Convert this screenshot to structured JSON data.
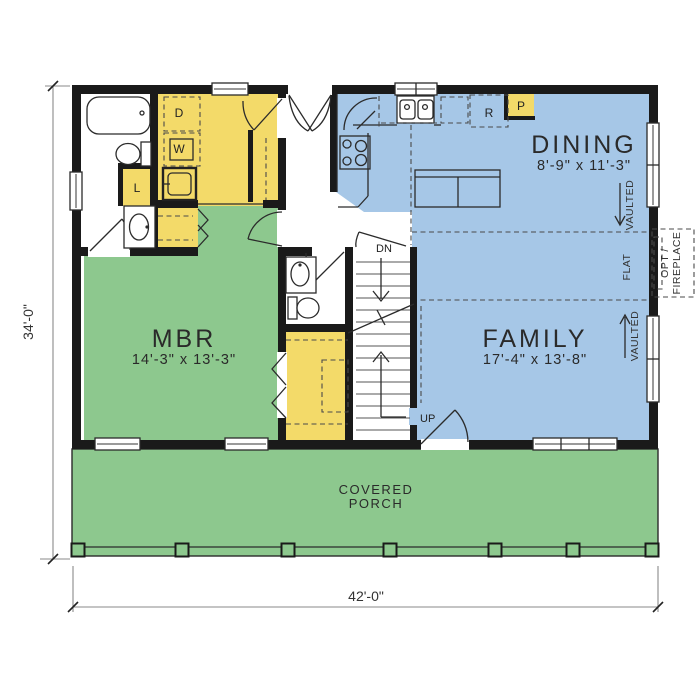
{
  "plan": {
    "type": "first-floor-plan",
    "overall_width": "42'-0\"",
    "overall_depth": "34'-0\""
  },
  "rooms": {
    "dining": {
      "name": "DINING",
      "size": "8'-9\" x 11'-3\""
    },
    "family": {
      "name": "FAMILY",
      "size": "17'-4\" x 13'-8\""
    },
    "mbr": {
      "name": "MBR",
      "size": "14'-3\" x 13'-3\""
    },
    "porch": {
      "line1": "COVERED",
      "line2": "PORCH"
    }
  },
  "appliances": {
    "dryer": "D",
    "washer": "W",
    "linen": "L",
    "refrigerator": "R",
    "pantry": "P"
  },
  "stairs": {
    "down": "DN",
    "up": "UP"
  },
  "ceiling": {
    "vaulted_dining": "VAULTED",
    "flat": "FLAT",
    "vaulted_family": "VAULTED"
  },
  "fireplace": {
    "line1": "OPT /",
    "line2": "FIREPLACE"
  },
  "colors": {
    "room_green": "#8dc88e",
    "room_blue": "#a6c7e7",
    "room_yellow": "#f3da69",
    "wall_black": "#1a1a1a",
    "dim_gray": "#8a8a8a",
    "text": "#2e2e2e"
  }
}
